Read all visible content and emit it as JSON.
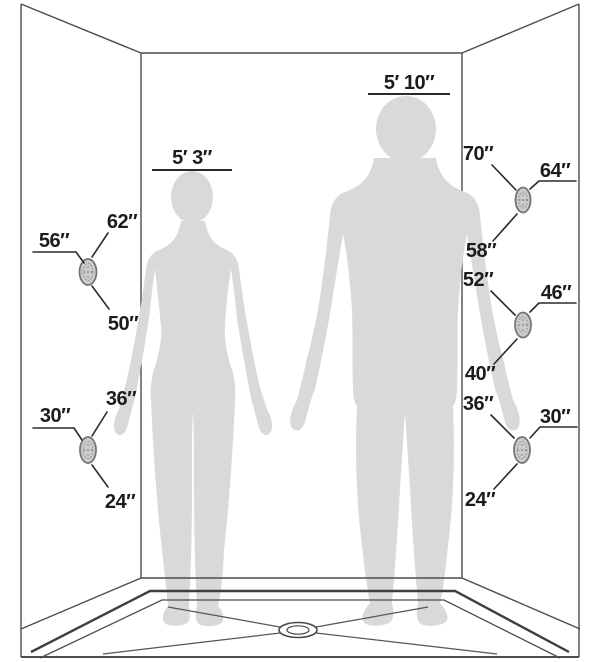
{
  "figures": {
    "female": {
      "height_label": "5′ 3″"
    },
    "male": {
      "height_label": "5′ 10″"
    }
  },
  "measurements": {
    "left_wall": [
      {
        "top": "62″",
        "side": "56″",
        "bottom": "50″"
      },
      {
        "top": "36″",
        "side": "30″",
        "bottom": "24″"
      }
    ],
    "right_wall": [
      {
        "top": "70″",
        "side": "64″",
        "bottom": "58″"
      },
      {
        "top": "52″",
        "side": "46″",
        "bottom": "40″"
      },
      {
        "top": "36″",
        "side": "30″",
        "bottom": "24″"
      }
    ]
  },
  "icons": {
    "spray_jet": "oval-nozzle",
    "drain": "concentric-ovals"
  },
  "colors": {
    "background": "#ffffff",
    "line": "#4d4d4d",
    "text": "#1c1c1c",
    "silhouette": "#d9d9d9",
    "jet_fill": "#cccccc",
    "jet_stroke": "#757575"
  }
}
